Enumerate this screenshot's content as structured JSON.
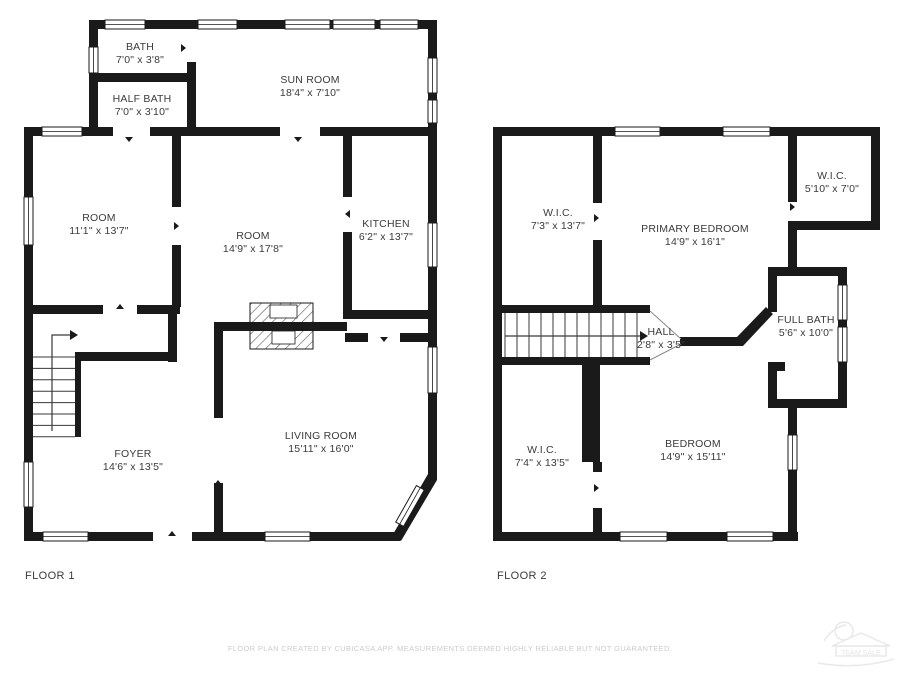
{
  "floors": [
    {
      "label": "FLOOR 1",
      "rooms": [
        {
          "name": "BATH",
          "dims": "7'0\" x 3'8\""
        },
        {
          "name": "HALF BATH",
          "dims": "7'0\" x 3'10\""
        },
        {
          "name": "SUN ROOM",
          "dims": "18'4\" x 7'10\""
        },
        {
          "name": "ROOM",
          "dims": "11'1\" x 13'7\""
        },
        {
          "name": "ROOM",
          "dims": "14'9\" x 17'8\""
        },
        {
          "name": "KITCHEN",
          "dims": "6'2\" x 13'7\""
        },
        {
          "name": "FOYER",
          "dims": "14'6\" x 13'5\""
        },
        {
          "name": "LIVING ROOM",
          "dims": "15'11\" x 16'0\""
        }
      ]
    },
    {
      "label": "FLOOR 2",
      "rooms": [
        {
          "name": "W.I.C.",
          "dims": "7'3\" x 13'7\""
        },
        {
          "name": "PRIMARY BEDROOM",
          "dims": "14'9\" x 16'1\""
        },
        {
          "name": "W.I.C.",
          "dims": "5'10\" x 7'0\""
        },
        {
          "name": "FULL BATH",
          "dims": "5'6\" x 10'0\""
        },
        {
          "name": "HALL",
          "dims": "2'8\" x 3'5\""
        },
        {
          "name": "W.I.C.",
          "dims": "7'4\" x 13'5\""
        },
        {
          "name": "BEDROOM",
          "dims": "14'9\" x 15'11\""
        }
      ]
    }
  ],
  "footer": {
    "disclaimer": "FLOOR PLAN CREATED BY CUBICASA APP. MEASUREMENTS DEEMED HIGHLY RELIABLE BUT NOT GUARANTEED."
  },
  "watermark": {
    "text": "TEAM SALE",
    "icon": "house-illustration"
  },
  "icons": {
    "stairs_direction": "up-arrow"
  },
  "colors": {
    "wall": "#1a1a1a",
    "room_text": "#3b3b3b",
    "disclaimer_text": "#cccccc",
    "watermark": "#e8e8e8",
    "background": "#ffffff"
  }
}
